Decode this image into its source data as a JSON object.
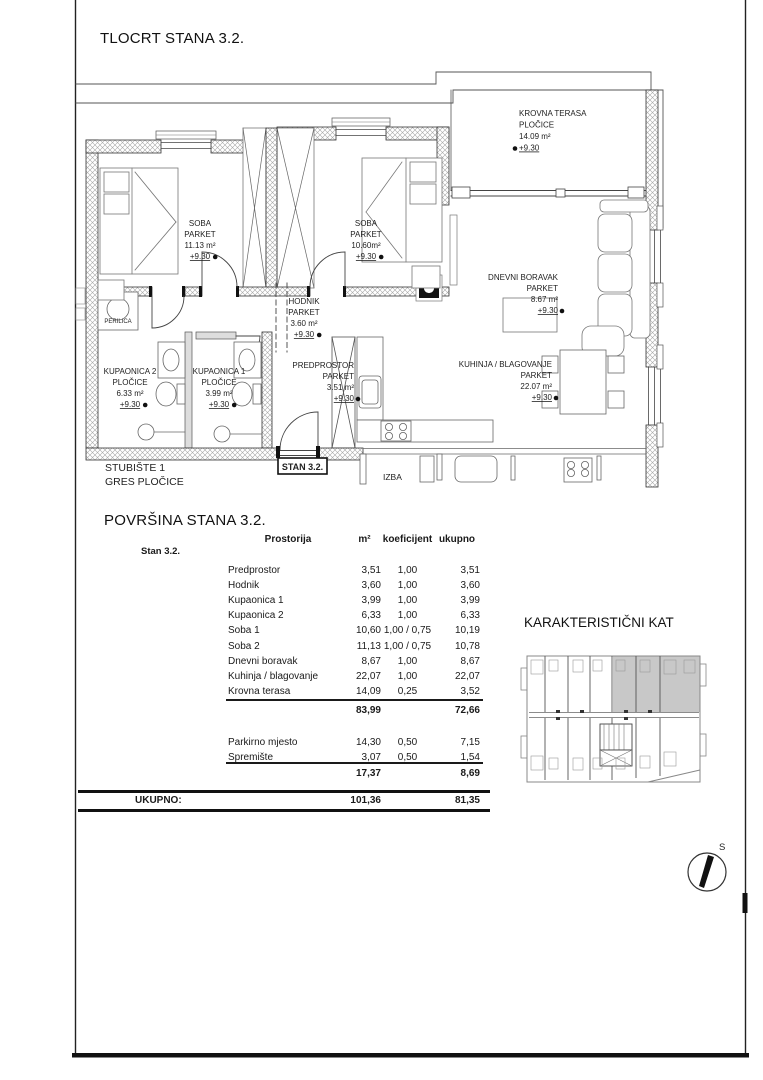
{
  "page": {
    "title": "TLOCRT STANA 3.2."
  },
  "floorplan": {
    "stan_label": "STAN 3.2.",
    "rooms": [
      {
        "id": "krovna-terasa",
        "align": "left",
        "x": 519,
        "y": 116,
        "fs": 8,
        "lh": 11.5,
        "lines": [
          "KROVNA TERASA",
          "PLOČICE",
          "14.09 m²",
          "+9.30"
        ]
      },
      {
        "id": "soba-2",
        "align": "center",
        "x": 200,
        "y": 226,
        "fs": 8,
        "lh": 11,
        "lines": [
          "SOBA",
          "PARKET",
          "11.13 m²",
          "+9.30"
        ]
      },
      {
        "id": "soba-1",
        "align": "center",
        "x": 366,
        "y": 226,
        "fs": 8,
        "lh": 11,
        "lines": [
          "SOBA",
          "PARKET",
          "10.60m²",
          "+9.30"
        ]
      },
      {
        "id": "hodnik",
        "align": "center",
        "x": 304,
        "y": 304,
        "fs": 8,
        "lh": 11,
        "lines": [
          "HODNIK",
          "PARKET",
          "3.60 m²",
          "+9.30"
        ]
      },
      {
        "id": "dnevni-boravak",
        "align": "right",
        "x": 558,
        "y": 280,
        "fs": 8,
        "lh": 11,
        "lines": [
          "DNEVNI BORAVAK",
          "PARKET",
          "8.67 m²",
          "+9.30"
        ]
      },
      {
        "id": "kupaonica-2",
        "align": "center",
        "x": 130,
        "y": 374,
        "fs": 8,
        "lh": 11,
        "lines": [
          "KUPAONICA 2",
          "PLOČICE",
          "6.33 m²",
          "+9.30"
        ]
      },
      {
        "id": "kupaonica-1",
        "align": "center",
        "x": 219,
        "y": 374,
        "fs": 8,
        "lh": 11,
        "lines": [
          "KUPAONICA 1",
          "PLOČICE",
          "3.99 m²",
          "+9.30"
        ]
      },
      {
        "id": "predprostor",
        "align": "right",
        "x": 354,
        "y": 368,
        "fs": 8,
        "lh": 11,
        "lines": [
          "PREDPROSTOR",
          "PARKET",
          "3.51 m²",
          "+9.30"
        ]
      },
      {
        "id": "kuhinja-blagovanje",
        "align": "right",
        "x": 552,
        "y": 367,
        "fs": 8,
        "lh": 11,
        "lines": [
          "KUHINJA / BLAGOVANJE",
          "PARKET",
          "22.07 m²",
          "+9.30"
        ]
      },
      {
        "id": "stubiste",
        "align": "left",
        "x": 105,
        "y": 471,
        "fs": 10.5,
        "lh": 14,
        "lines": [
          "STUBIŠTE 1",
          "GRES PLOČICE"
        ]
      },
      {
        "id": "izba",
        "align": "left",
        "x": 383,
        "y": 480,
        "fs": 8.5,
        "lh": 11,
        "lines": [
          "IZBA"
        ]
      },
      {
        "id": "perilica",
        "align": "center",
        "x": 118,
        "y": 323,
        "fs": 6,
        "lh": 8,
        "lines": [
          "PERILICA"
        ]
      }
    ]
  },
  "table": {
    "title": "POVRŠINA STANA 3.2.",
    "columns": [
      "Prostorija",
      "m²",
      "koeficijent",
      "ukupno"
    ],
    "group_label": "Stan 3.2.",
    "rows": [
      {
        "name": "Predprostor",
        "m2": "3,51",
        "koef": "1,00",
        "total": "3,51"
      },
      {
        "name": "Hodnik",
        "m2": "3,60",
        "koef": "1,00",
        "total": "3,60"
      },
      {
        "name": "Kupaonica 1",
        "m2": "3,99",
        "koef": "1,00",
        "total": "3,99"
      },
      {
        "name": "Kupaonica 2",
        "m2": "6,33",
        "koef": "1,00",
        "total": "6,33"
      },
      {
        "name": "Soba 1",
        "m2": "10,60",
        "koef": "1,00 / 0,75",
        "total": "10,19"
      },
      {
        "name": "Soba 2",
        "m2": "11,13",
        "koef": "1,00 / 0,75",
        "total": "10,78"
      },
      {
        "name": "Dnevni boravak",
        "m2": "8,67",
        "koef": "1,00",
        "total": "8,67"
      },
      {
        "name": "Kuhinja / blagovanje",
        "m2": "22,07",
        "koef": "1,00",
        "total": "22,07"
      },
      {
        "name": "Krovna terasa",
        "m2": "14,09",
        "koef": "0,25",
        "total": "3,52"
      }
    ],
    "subtotal1": {
      "m2": "83,99",
      "total": "72,66"
    },
    "rows2": [
      {
        "name": "Parkirno mjesto",
        "m2": "14,30",
        "koef": "0,50",
        "total": "7,15"
      },
      {
        "name": "Spremište",
        "m2": "3,07",
        "koef": "0,50",
        "total": "1,54"
      }
    ],
    "subtotal2": {
      "m2": "17,37",
      "total": "8,69"
    },
    "total_label": "UKUPNO:",
    "total": {
      "m2": "101,36",
      "total": "81,35"
    }
  },
  "keyplan": {
    "title": "KARAKTERISTIČNI KAT"
  },
  "compass": {
    "label": "S"
  }
}
